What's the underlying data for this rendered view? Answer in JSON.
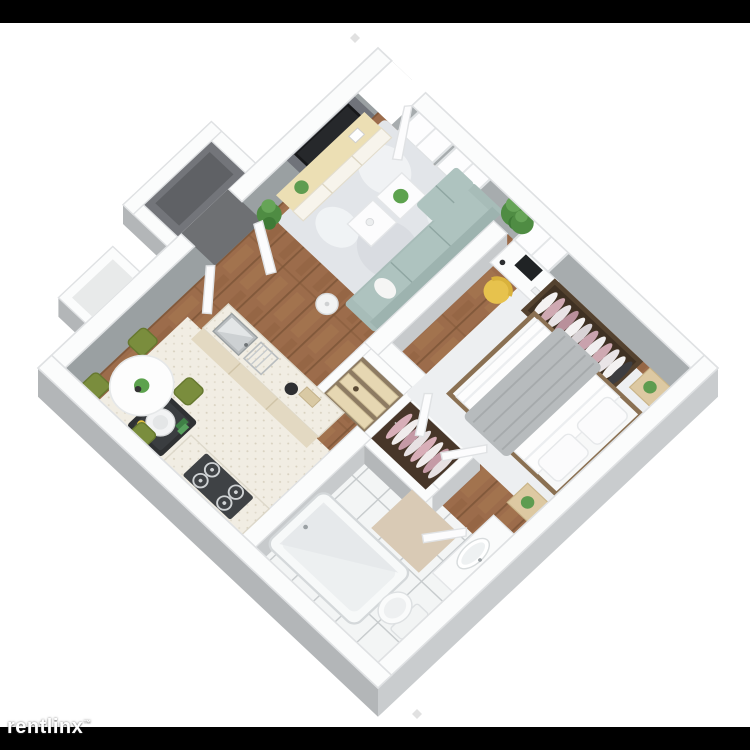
{
  "watermark": {
    "text": "rentlinx",
    "trademark": "™"
  },
  "scene": {
    "title": "one-bedroom-apartment-3d-floor-plan",
    "palette": {
      "letterbox": "#000000",
      "floor_wood": "#9c6c4b",
      "wall_cap": "#fbfcfc",
      "wall_face_left": "#9aa0a2",
      "wall_face_right": "#a7acae",
      "outer_face_dark": "#b3b6b8",
      "outer_face_light": "#c9ccce",
      "sofa_teal": "#a7bcb8",
      "desk_chair_yellow": "#e7c24d",
      "dining_chair_green": "#7a8d3d",
      "bed_blanket_gray": "#b7bbbd",
      "closet_clothes_pink": "#cfa9b2",
      "counter_speckle": "#f1ede3",
      "bathroom_tile": "#f3f5f5",
      "tv_black": "#17181a",
      "plant_green": "#5e9c50"
    }
  }
}
